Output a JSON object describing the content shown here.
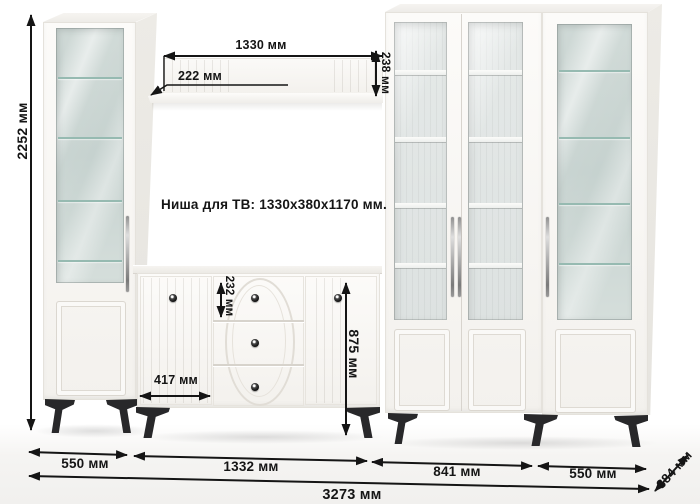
{
  "diagram": {
    "kind": "furniture dimension drawing",
    "labels": {
      "total_height": "2252 мм",
      "shelf_length": "1330 мм",
      "shelf_offset": "222 мм",
      "shelf_end_height": "238 мм",
      "tv_niche": "Ниша для ТВ: 1330x380x1170 мм.",
      "drawer_height": "232 мм",
      "sideboard_height": "875 мм",
      "sideboard_door_width": "417 мм",
      "left_cabinet_width": "550 мм",
      "sideboard_width": "1332 мм",
      "bookcase_width": "841 мм",
      "right_cabinet_width": "550 мм",
      "total_width": "3273 мм",
      "depth": "384 мм"
    },
    "colors": {
      "dimension_ink": "#151515",
      "furniture_body": "#faf9f7",
      "glass_tint": "#cdd8d4",
      "glass_shelf": "#96bab1",
      "legs": "#28282a"
    }
  }
}
